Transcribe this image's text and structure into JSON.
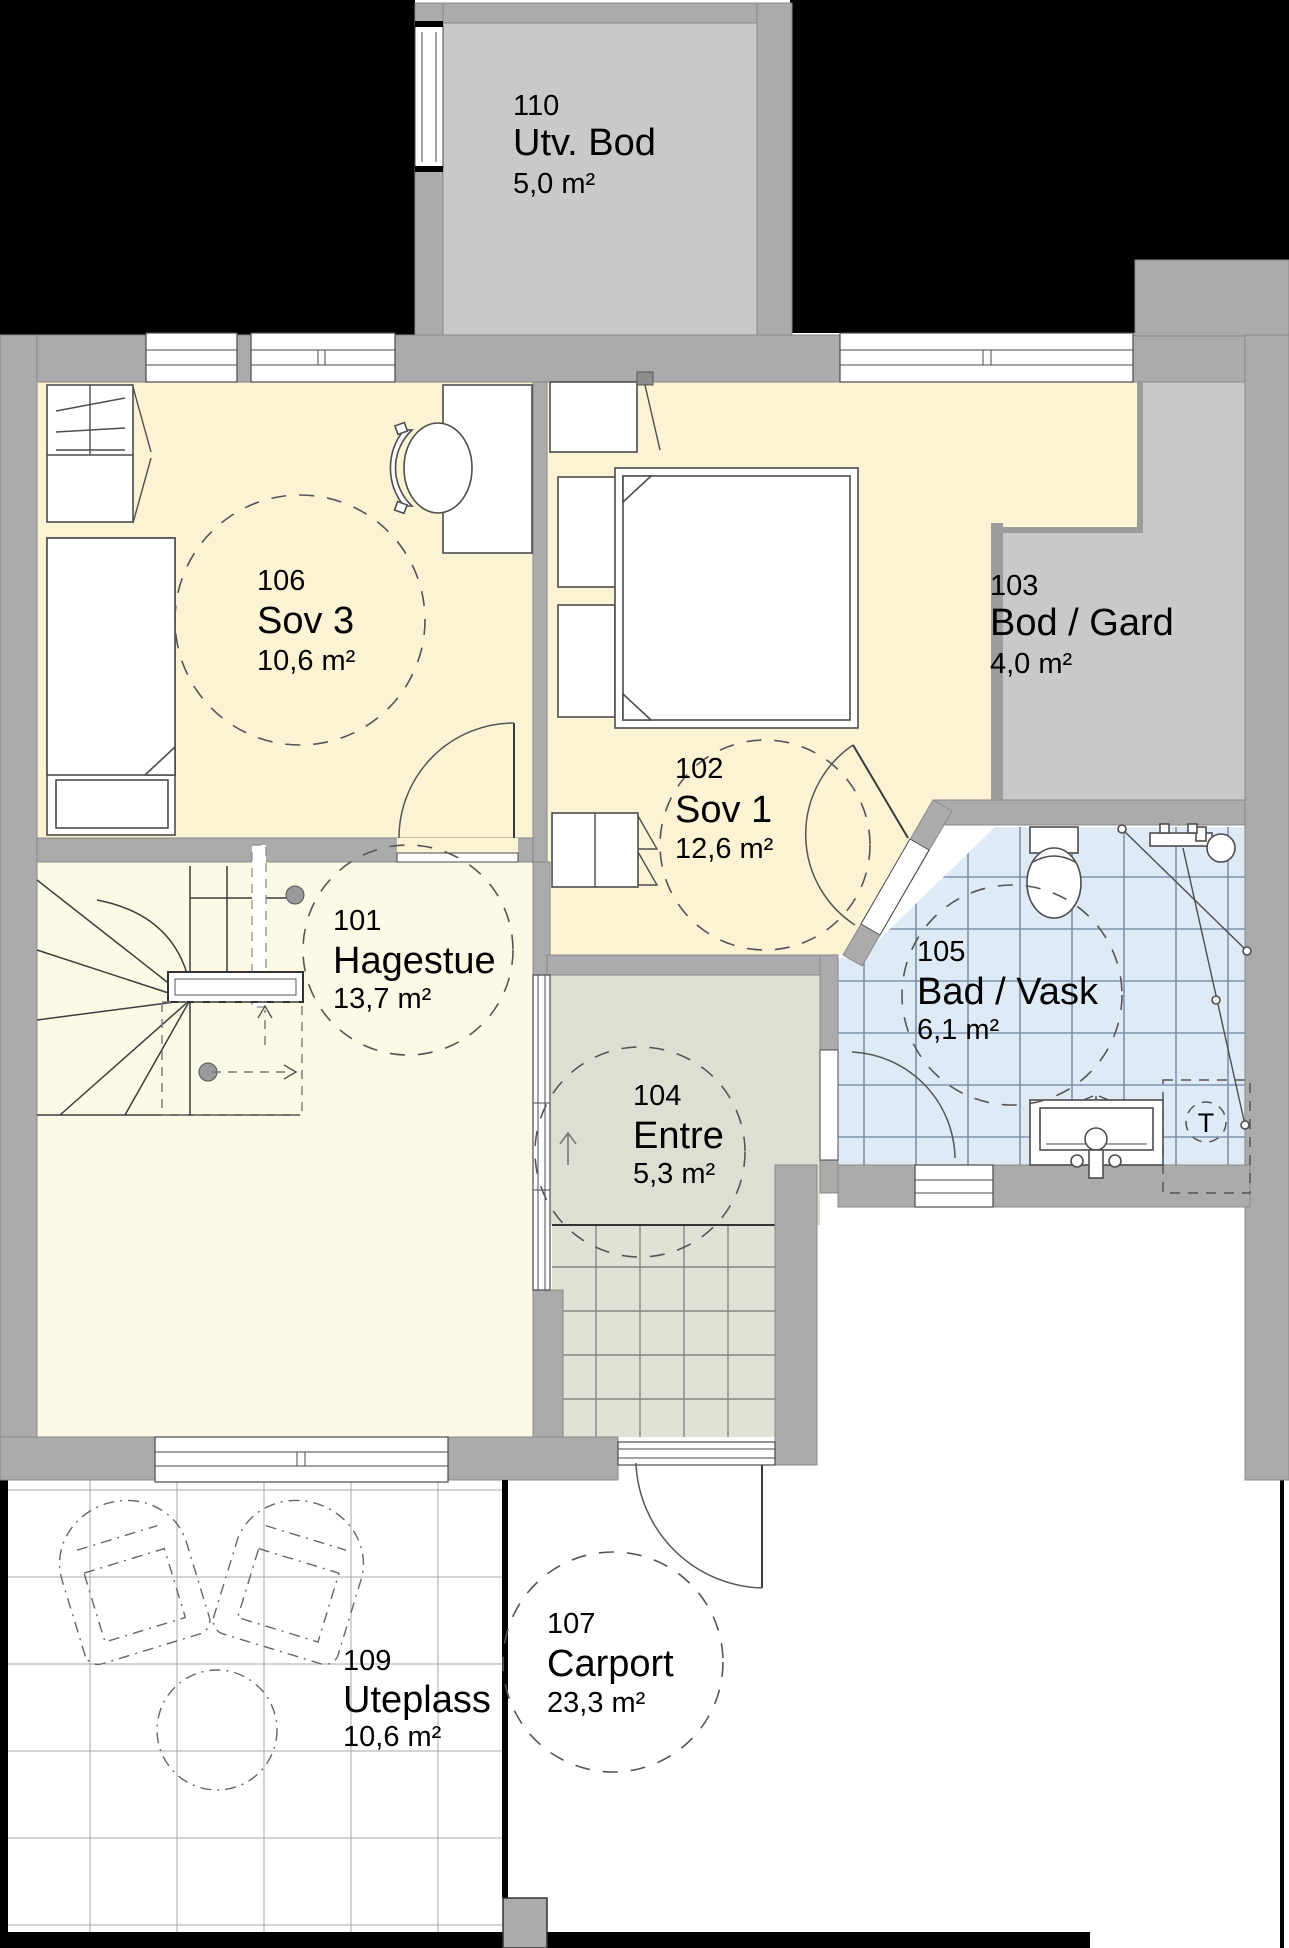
{
  "plan": {
    "title": "First floor plan",
    "rooms": [
      {
        "number": "110",
        "name": "Utv. Bod",
        "area": "5,0 m²"
      },
      {
        "number": "106",
        "name": "Sov 3",
        "area": "10,6 m²"
      },
      {
        "number": "102",
        "name": "Sov 1",
        "area": "12,6 m²"
      },
      {
        "number": "103",
        "name": "Bod / Gard",
        "area": "4,0 m²"
      },
      {
        "number": "101",
        "name": "Hagestue",
        "area": "13,7 m²"
      },
      {
        "number": "104",
        "name": "Entre",
        "area": "5,3 m²"
      },
      {
        "number": "105",
        "name": "Bad / Vask",
        "area": "6,1 m²"
      },
      {
        "number": "107",
        "name": "Carport",
        "area": "23,3 m²"
      },
      {
        "number": "109",
        "name": "Uteplass",
        "area": "10,6 m²"
      }
    ],
    "symbols": {
      "appliance_label": "T"
    },
    "colors": {
      "wall": "#ababab",
      "floor_bedroom": "#fbf3d4",
      "floor_hagestue": "#fcfae6",
      "floor_entre": "#dedfd2",
      "floor_tiles": "#e1e2d6",
      "floor_bath": "#deebf7",
      "floor_storage": "#c9c9c9",
      "background": "#000000"
    }
  }
}
